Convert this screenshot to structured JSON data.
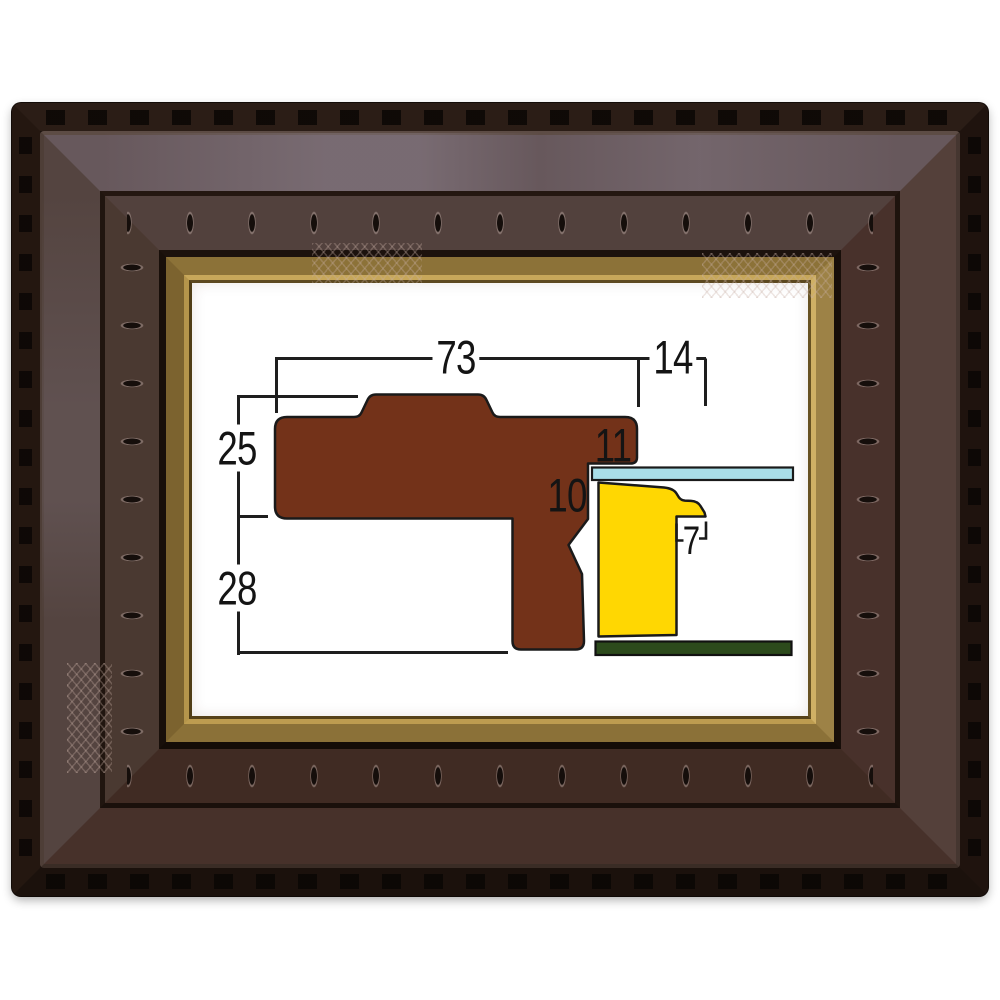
{
  "diagram": {
    "labels": {
      "total_width": "73",
      "extension_width": "14",
      "upper_height": "25",
      "lower_height": "28",
      "rabbet_depth": "11",
      "step_depth": "10",
      "lip_width": "7"
    },
    "colors": {
      "moulding_brown": "#733219",
      "liner_yellow": "#ffd702",
      "glass_blue": "#a9dee8",
      "backing_green": "#2c4a1c",
      "dimension_line": "#1e1e1e"
    }
  },
  "photo": {
    "colors": {
      "wood_dark_brown": "#47312a",
      "gold_liner": "#9d8246",
      "mat_white": "#ffffff"
    }
  }
}
